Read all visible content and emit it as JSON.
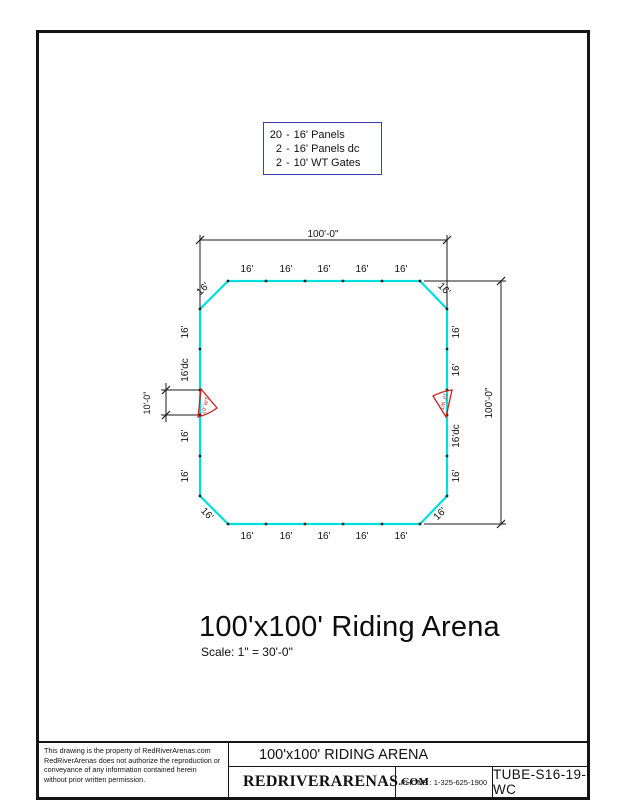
{
  "legend": {
    "items": [
      {
        "count": "20",
        "sep": "-",
        "label": "16' Panels"
      },
      {
        "count": "2",
        "sep": "-",
        "label": "16' Panels dc"
      },
      {
        "count": "2",
        "sep": "-",
        "label": "10' WT Gates"
      }
    ]
  },
  "labels": {
    "panel": "16'",
    "panel_dc": "16'dc",
    "gate": "10' WT"
  },
  "dimensions": {
    "width": "100'-0\"",
    "height": "100'-0\"",
    "gate_opening": "10'-0\""
  },
  "title": {
    "main": "100'x100' Riding Arena",
    "scale": "Scale: 1\" = 30'-0\""
  },
  "title_block": {
    "disclaimer_lines": [
      "This drawing is the property of RedRiverArenas.com",
      "RedRiverArenas does not authorize the reproduction or",
      "conveyance of any information contained herein",
      "without prior written permission."
    ],
    "drawing_title": "100'x100' RIDING ARENA",
    "company_main": "REDRIVERARENAS",
    "company_suffix": ".COM",
    "phone": "PHONE : 1-325-625-1900",
    "drawing_number": "TUBE-S16-19-WC"
  },
  "colors": {
    "arena_line": "#00dede",
    "gate_symbol": "#cc2222",
    "legend_border": "#3c3cb4",
    "line": "#141414"
  }
}
